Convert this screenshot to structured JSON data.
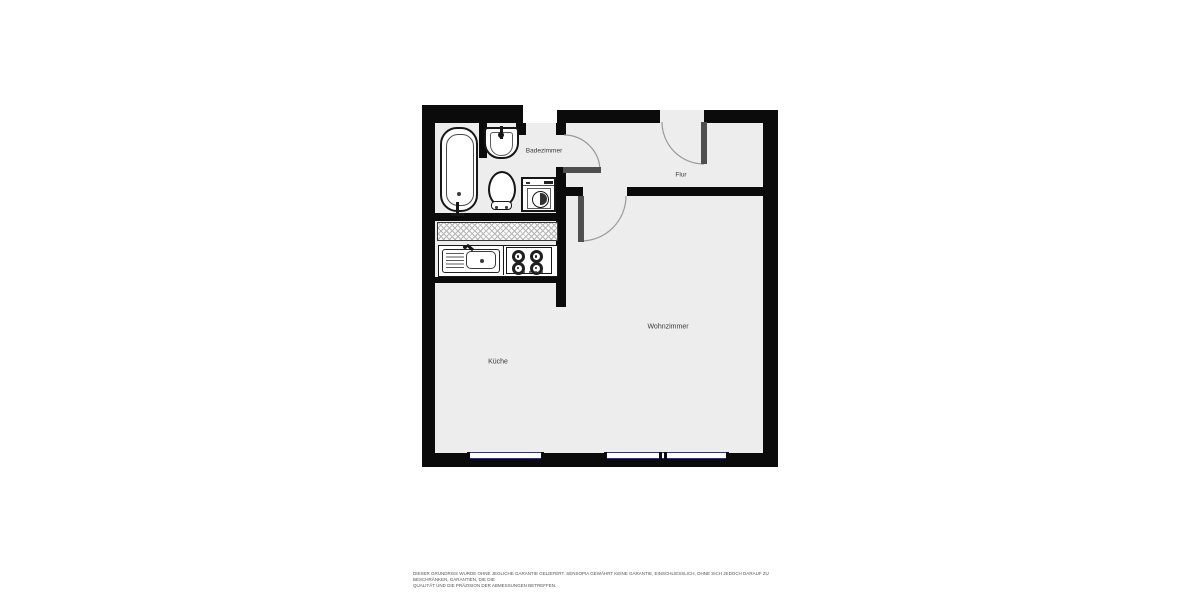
{
  "floorplan": {
    "rooms": [
      {
        "key": "badezimmer",
        "label": "Badezimmer"
      },
      {
        "key": "flur",
        "label": "Flur"
      },
      {
        "key": "wohnzimmer",
        "label": "Wohnzimmer"
      },
      {
        "key": "kueche",
        "label": "Küche"
      }
    ],
    "fixtures": {
      "bathroom": [
        "bathtub",
        "washbasin",
        "toilet",
        "washing-machine"
      ],
      "kitchen": [
        "kitchen-sink",
        "stove-4-burners"
      ]
    },
    "colors": {
      "wall": "#0b0b0b",
      "room_fill": "#ededed",
      "window_blue": "#2b2bb8",
      "door_leaf": "#4f4f4f",
      "swing_arc": "#9a9a9a"
    },
    "disclaimer": {
      "line1": "DIESER GRUNDRISS WURDE OHNE JEGLICHE GARANTIE GELIEFERT. SENSOPIA GEWÄHRT KEINE GARANTIE, EINSCHLIESSLICH, OHNE SICH JEDOCH DARAUF ZU BESCHRÄNKEN, GARANTIEN, DIE DIE",
      "line2": "QUALITÄT UND DIE PRÄZISION DER ABMESSUNGEN BETREFFEN."
    }
  }
}
